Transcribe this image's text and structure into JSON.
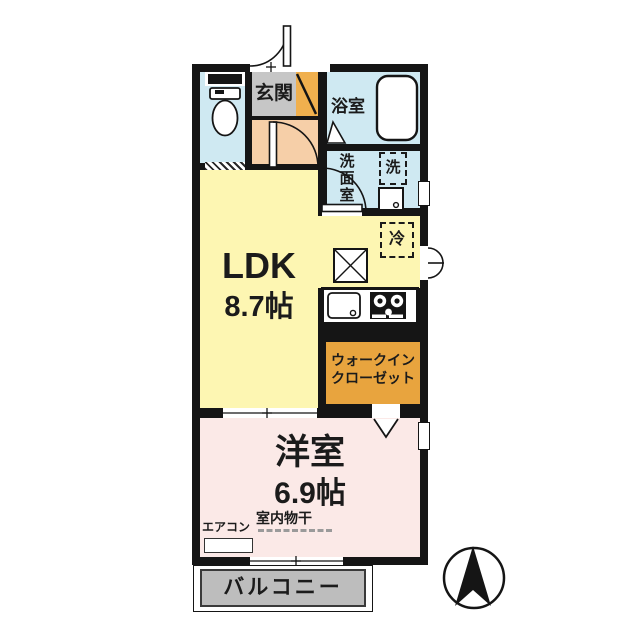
{
  "plan": {
    "entrance": "玄関",
    "bathroom": "浴室",
    "washroom": "洗面室",
    "washer": "洗",
    "fridge": "冷",
    "ldk_label": "LDK",
    "ldk_size": "8.7帖",
    "closet_line1": "ウォークイン",
    "closet_line2": "クローゼット",
    "bedroom_label": "洋室",
    "bedroom_size": "6.9帖",
    "aircon": "エアコン",
    "laundry": "室内物干",
    "balcony": "バルコニー"
  },
  "colors": {
    "wall": "#151515",
    "water_rooms": "#cfe9f2",
    "entrance_floor": "#c6c6c6",
    "shoe_cabinet": "#f0b04e",
    "hall": "#f6cfa8",
    "ldk": "#fdf6b2",
    "closet": "#e8a43e",
    "bedroom": "#fbe9e7",
    "balcony": "#bdbdbd"
  },
  "compass": {
    "direction": "N"
  }
}
